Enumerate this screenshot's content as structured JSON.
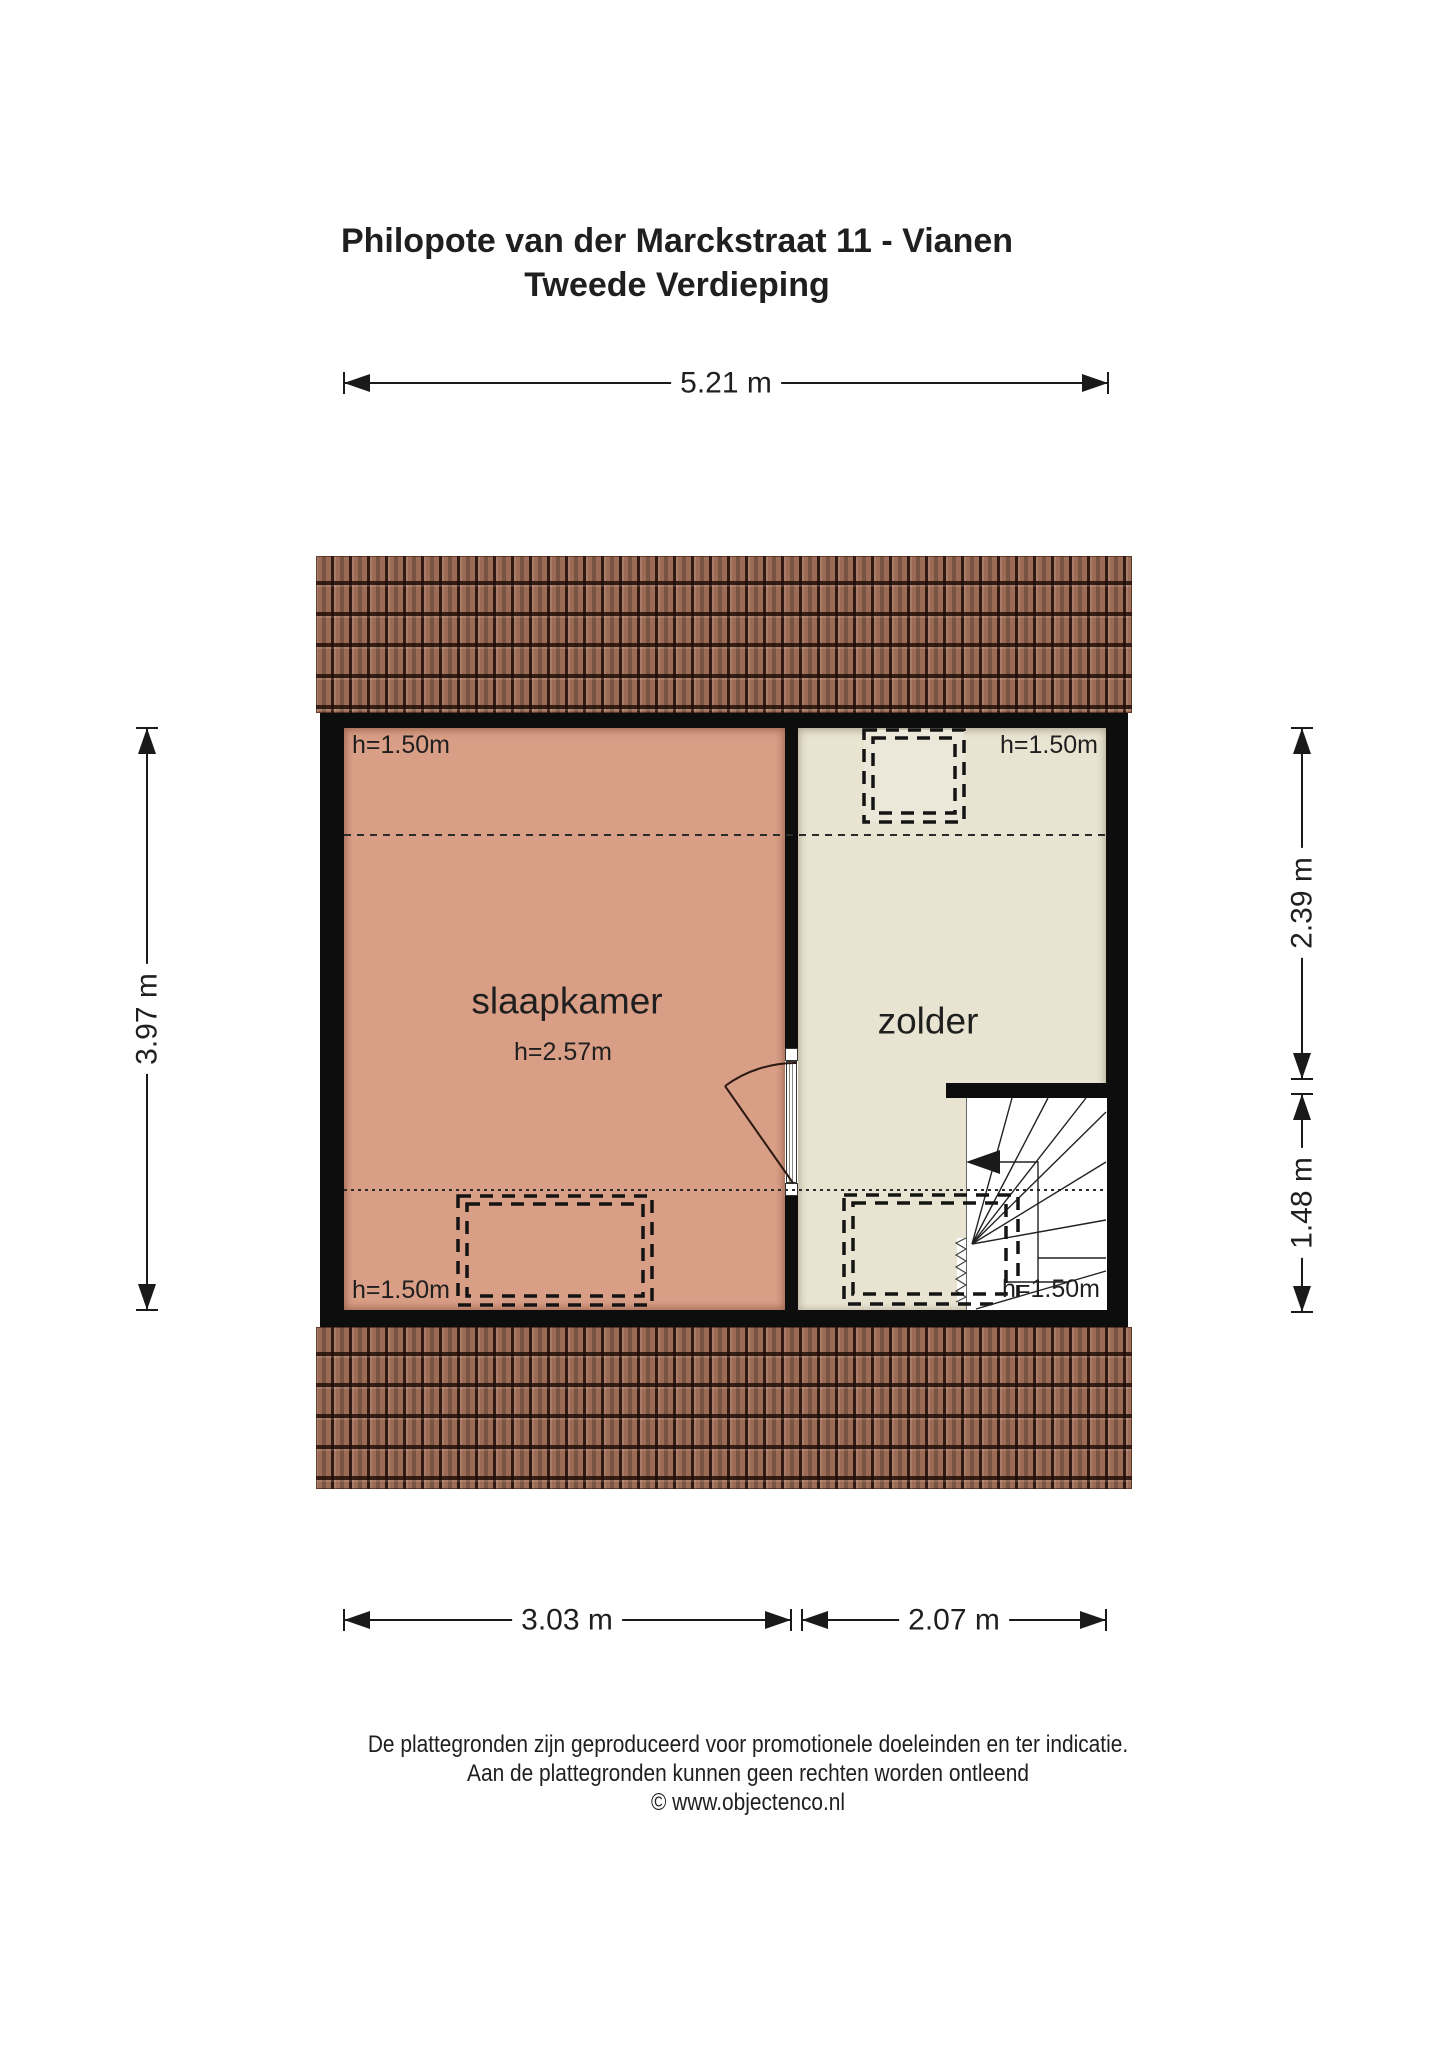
{
  "page": {
    "title_line1": "Philopote van der Marckstraat 11 - Vianen",
    "title_line2": "Tweede Verdieping"
  },
  "dimensions": {
    "top_width": "5.21 m",
    "left_height": "3.97 m",
    "right_upper": "2.39 m",
    "right_lower": "1.48 m",
    "bottom_left": "3.03 m",
    "bottom_right": "2.07 m"
  },
  "rooms": {
    "bedroom": {
      "name": "slaapkamer",
      "ceiling_height": "h=2.57m",
      "corner_note_top": "h=1.50m",
      "corner_note_bottom": "h=1.50m"
    },
    "attic": {
      "name": "zolder",
      "corner_note_top": "h=1.50m"
    },
    "stairs": {
      "corner_note_bottom": "h=1.50m"
    }
  },
  "footer": {
    "line1": "De plattegronden zijn geproduceerd voor promotionele doeleinden en ter indicatie.",
    "line2": "Aan de plattegronden kunnen geen rechten worden ontleend",
    "line3": "© www.objectenco.nl"
  },
  "colors": {
    "wall": "#0d0d0d",
    "bedroom_fill": "#d99e86",
    "attic_fill": "#e9e4d1",
    "roof_tile": "#9b6b55",
    "stair_area": "#ffffff",
    "line": "#1a1a1a"
  }
}
